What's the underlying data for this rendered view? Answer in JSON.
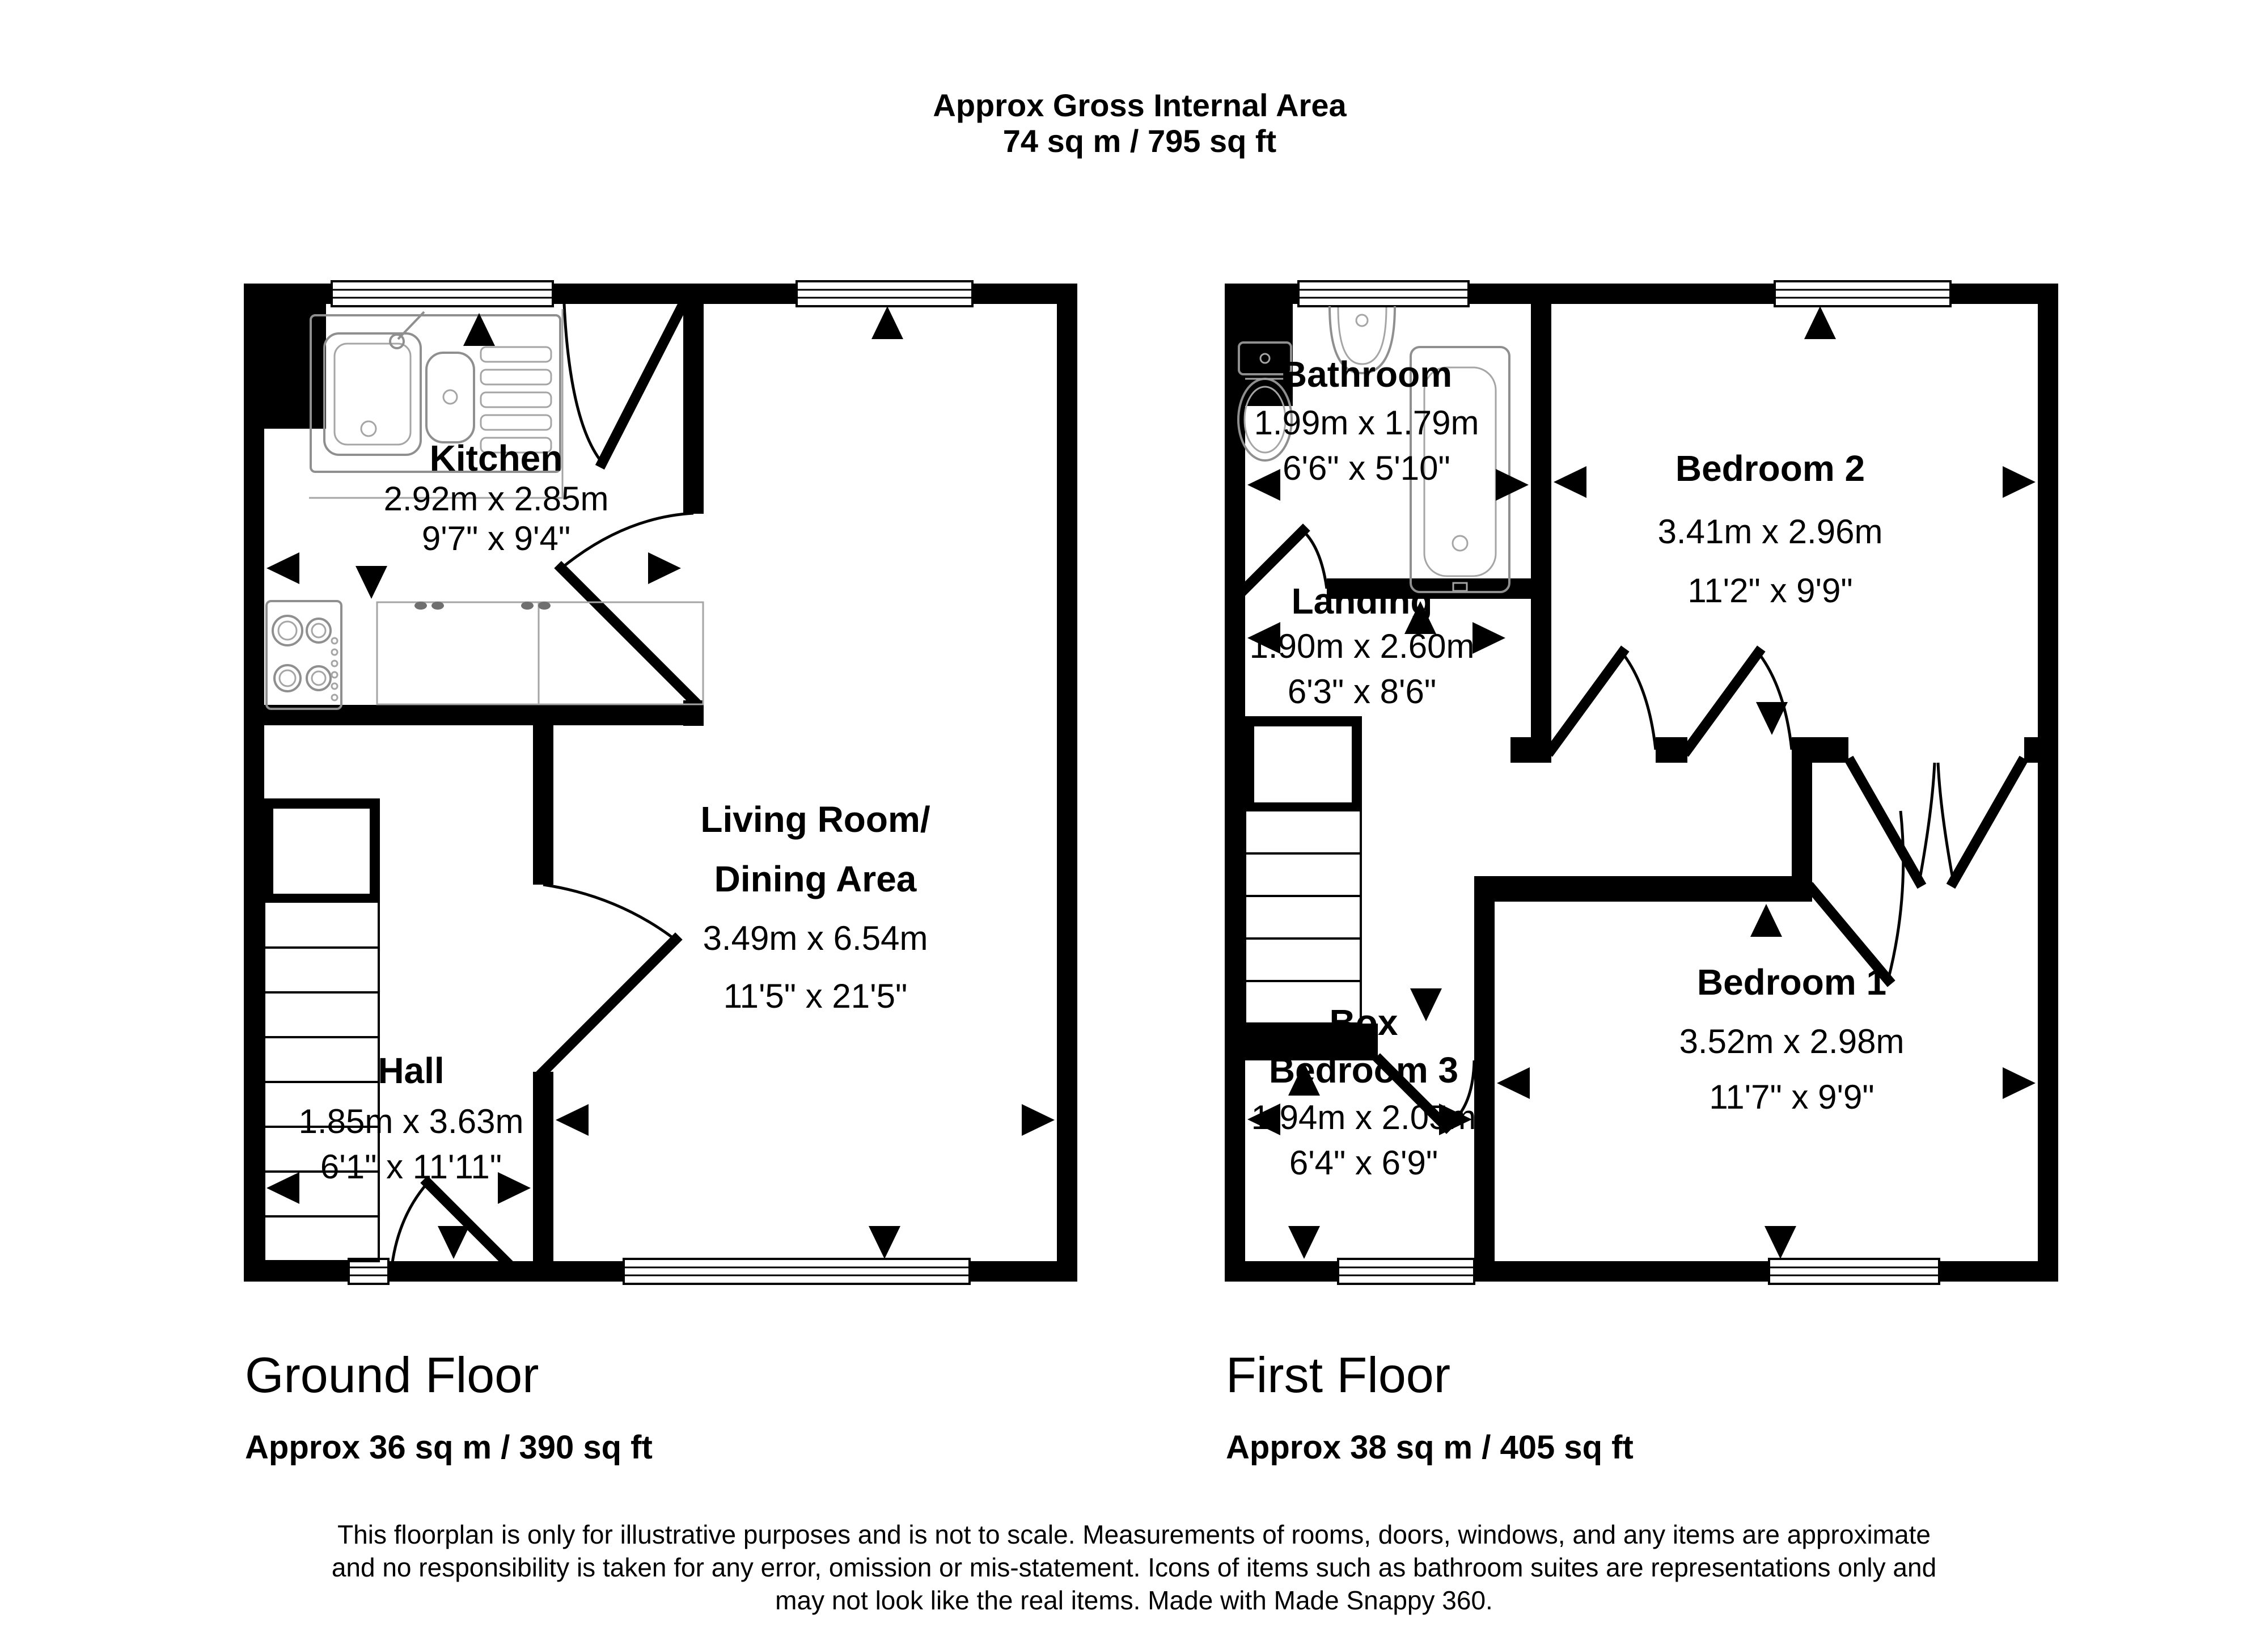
{
  "title": {
    "line1": "Approx Gross Internal Area",
    "line2": "74 sq m / 795 sq ft"
  },
  "floors": {
    "ground": {
      "label": "Ground Floor",
      "area": "Approx 36 sq m / 390 sq ft",
      "rooms": {
        "kitchen": {
          "name": "Kitchen",
          "metric": "2.92m x 2.85m",
          "imperial": "9'7\" x 9'4\""
        },
        "living": {
          "name1": "Living Room/",
          "name2": "Dining Area",
          "metric": "3.49m x 6.54m",
          "imperial": "11'5\" x 21'5\""
        },
        "hall": {
          "name": "Hall",
          "metric": "1.85m x 3.63m",
          "imperial": "6'1\" x 11'11\""
        }
      }
    },
    "first": {
      "label": "First Floor",
      "area": "Approx 38 sq m / 405 sq ft",
      "rooms": {
        "bathroom": {
          "name": "Bathroom",
          "metric": "1.99m x 1.79m",
          "imperial": "6'6\" x 5'10\""
        },
        "bedroom2": {
          "name": "Bedroom 2",
          "metric": "3.41m x 2.96m",
          "imperial": "11'2\" x 9'9\""
        },
        "landing": {
          "name": "Landing",
          "metric": "1.90m x 2.60m",
          "imperial": "6'3\" x 8'6\""
        },
        "box_bedroom3": {
          "name1": "Box",
          "name2": "Bedroom 3",
          "metric": "1.94m x 2.05m",
          "imperial": "6'4\" x 6'9\""
        },
        "bedroom1": {
          "name": "Bedroom 1",
          "metric": "3.52m x 2.98m",
          "imperial": "11'7\" x 9'9\""
        }
      }
    }
  },
  "disclaimer": {
    "line1": "This floorplan is only for illustrative purposes and is not to scale. Measurements of rooms, doors, windows, and any items are approximate",
    "line2": "and no responsibility is taken for any error, omission or mis-statement. Icons of items such as bathroom suites are representations only and",
    "line3": "may not look like the real items. Made with Made Snappy 360."
  },
  "colors": {
    "wall": "#000000",
    "fixture": "#8f8f8f",
    "background": "#ffffff"
  }
}
